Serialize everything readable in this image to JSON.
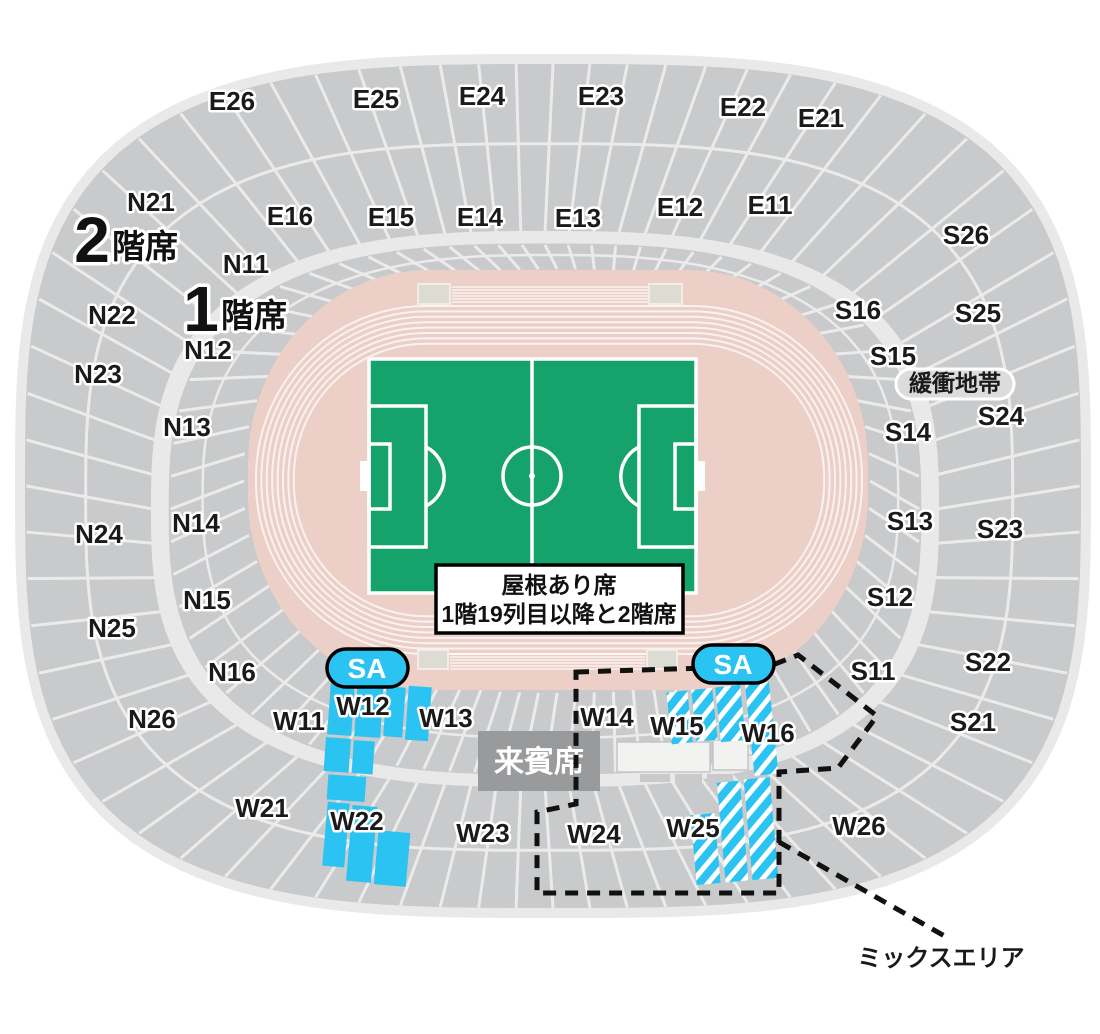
{
  "floors": {
    "second": {
      "num": "2",
      "suffix": "階席"
    },
    "first": {
      "num": "1",
      "suffix": "階席"
    }
  },
  "sections": {
    "E26": "E26",
    "E25": "E25",
    "E24": "E24",
    "E23": "E23",
    "E22": "E22",
    "E21": "E21",
    "E16": "E16",
    "E15": "E15",
    "E14": "E14",
    "E13": "E13",
    "E12": "E12",
    "E11": "E11",
    "N21": "N21",
    "N22": "N22",
    "N23": "N23",
    "N24": "N24",
    "N25": "N25",
    "N26": "N26",
    "N11": "N11",
    "N12": "N12",
    "N13": "N13",
    "N14": "N14",
    "N15": "N15",
    "N16": "N16",
    "S26": "S26",
    "S25": "S25",
    "S24": "S24",
    "S23": "S23",
    "S22": "S22",
    "S21": "S21",
    "S16": "S16",
    "S15": "S15",
    "S14": "S14",
    "S13": "S13",
    "S12": "S12",
    "S11": "S11",
    "W11": "W11",
    "W12": "W12",
    "W13": "W13",
    "W14": "W14",
    "W15": "W15",
    "W16": "W16",
    "W21": "W21",
    "W22": "W22",
    "W23": "W23",
    "W24": "W24",
    "W25": "W25",
    "W26": "W26"
  },
  "badges": {
    "sa": "SA"
  },
  "labels": {
    "buffer_zone": "緩衝地帯",
    "vip_seats": "来賓席",
    "mix_area": "ミックスエリア",
    "roof_note_line1": "屋根あり席",
    "roof_note_line2": "1階19列目以降と2階席"
  },
  "colors": {
    "highlight_cyan": "#2AC3F2",
    "pitch_green": "#16A26B",
    "track_pink": "#ECD0C8",
    "seat_gray": "#C9CACB",
    "walkway_gray": "#E9E9E9",
    "vip_box_gray": "#999A9B"
  }
}
